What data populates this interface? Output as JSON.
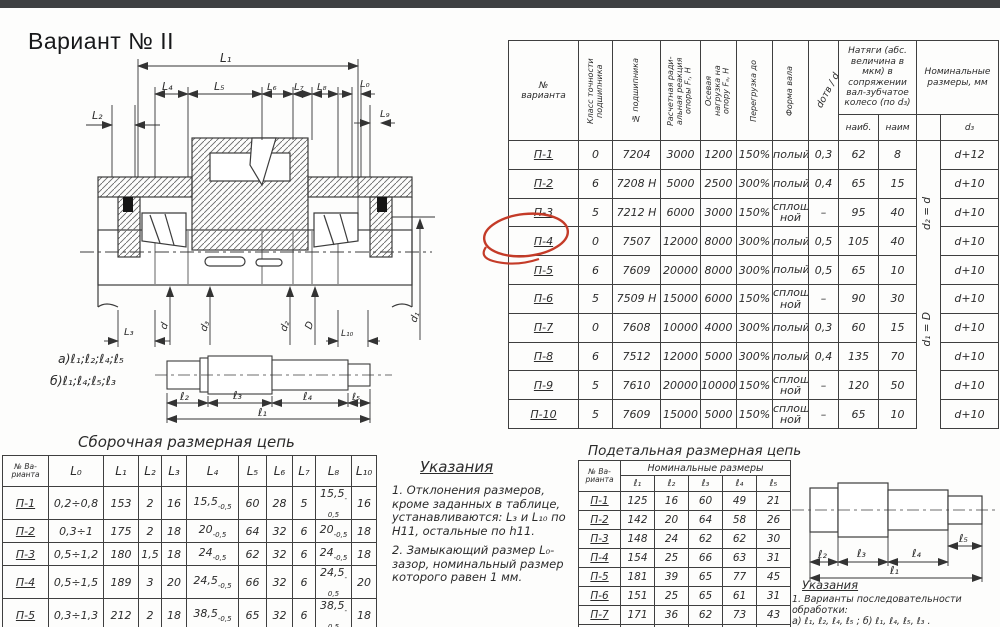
{
  "title": "Вариант № II",
  "colors": {
    "ink": "#2b2b2b",
    "line": "#3f3f3f",
    "red_mark": "#c43b28",
    "topbar": "#3e4042"
  },
  "drawing": {
    "labels": {
      "L1": "L₁",
      "L2": "L₂",
      "L4": "L₄",
      "L5": "L₅",
      "L6": "L₆",
      "L7": "L₇",
      "L8": "L₈",
      "L0": "L₀",
      "L9": "L₉",
      "L3": "L₃",
      "d": "d",
      "d3": "d₃",
      "d2": "d₂",
      "D": "D",
      "L10": "L₁₀",
      "d1": "d₁",
      "seq_a": "а)ℓ₁;ℓ₂;ℓ₄;ℓ₅",
      "seq_b": "б)ℓ₁;ℓ₄;ℓ₅;ℓ₃",
      "s_l1": "ℓ₁",
      "s_l2": "ℓ₂",
      "s_l3": "ℓ₃",
      "s_l4": "ℓ₄",
      "s_l5": "ℓ₅"
    }
  },
  "right_shaft": {
    "labels": {
      "l1": "ℓ₁",
      "l2": "ℓ₂",
      "l3": "ℓ₃",
      "l4": "ℓ₄",
      "l5": "ℓ₅"
    }
  },
  "main_table": {
    "header": {
      "variant": "№\nварианта",
      "cls": "Класс точности подшипника",
      "bearing_no": "№ подшипника",
      "radial": "Расчетная ради-альная реакция опоры Fᵣ, Н",
      "axial": "Осевая нагрузка на опору Fₐ, Н",
      "overload": "Перегрузка до",
      "form": "Форма вала",
      "ratio": "dотв / d",
      "tension": "Натяги (абс. величина в мкм) в сопряжении вал-зубчатое колесо (по d₃)",
      "max": "наиб.",
      "min": "наим",
      "nominal": "Номинальные размеры, мм",
      "d3": "d₃",
      "d2_eq": "d₂ = d",
      "d1_eq": "d₁ = D"
    },
    "rows": [
      {
        "v": "П-1",
        "cls": "0",
        "no": "7204",
        "fr": "3000",
        "fa": "1200",
        "ov": "150%",
        "form": "полый",
        "ratio": "0,3",
        "max": "62",
        "min": "8",
        "d3": "d+12"
      },
      {
        "v": "П-2",
        "cls": "6",
        "no": "7208 Н",
        "fr": "5000",
        "fa": "2500",
        "ov": "300%",
        "form": "полый",
        "ratio": "0,4",
        "max": "65",
        "min": "15",
        "d3": "d+10"
      },
      {
        "v": "П-3",
        "cls": "5",
        "no": "7212 Н",
        "fr": "6000",
        "fa": "3000",
        "ov": "150%",
        "form": "сплош-ной",
        "ratio": "–",
        "max": "95",
        "min": "40",
        "d3": "d+10"
      },
      {
        "v": "П-4",
        "cls": "0",
        "no": "7507",
        "fr": "12000",
        "fa": "8000",
        "ov": "300%",
        "form": "полый",
        "ratio": "0,5",
        "max": "105",
        "min": "40",
        "d3": "d+10"
      },
      {
        "v": "П-5",
        "cls": "6",
        "no": "7609",
        "fr": "20000",
        "fa": "8000",
        "ov": "300%",
        "form": "полый",
        "ratio": "0,5",
        "max": "65",
        "min": "10",
        "d3": "d+10"
      },
      {
        "v": "П-6",
        "cls": "5",
        "no": "7509 Н",
        "fr": "15000",
        "fa": "6000",
        "ov": "150%",
        "form": "сплош-ной",
        "ratio": "–",
        "max": "90",
        "min": "30",
        "d3": "d+10"
      },
      {
        "v": "П-7",
        "cls": "0",
        "no": "7608",
        "fr": "10000",
        "fa": "4000",
        "ov": "300%",
        "form": "полый",
        "ratio": "0,3",
        "max": "60",
        "min": "15",
        "d3": "d+10"
      },
      {
        "v": "П-8",
        "cls": "6",
        "no": "7512",
        "fr": "12000",
        "fa": "5000",
        "ov": "300%",
        "form": "полый",
        "ratio": "0,4",
        "max": "135",
        "min": "70",
        "d3": "d+10"
      },
      {
        "v": "П-9",
        "cls": "5",
        "no": "7610",
        "fr": "20000",
        "fa": "10000",
        "ov": "150%",
        "form": "сплош-ной",
        "ratio": "–",
        "max": "120",
        "min": "50",
        "d3": "d+10"
      },
      {
        "v": "П-10",
        "cls": "5",
        "no": "7609",
        "fr": "15000",
        "fa": "5000",
        "ov": "150%",
        "form": "сплош-ной",
        "ratio": "–",
        "max": "65",
        "min": "10",
        "d3": "d+10"
      }
    ]
  },
  "assembly_table": {
    "title": "Сборочная размерная цепь",
    "col_variant": "№ Ва-\nрианта",
    "cols": {
      "l0": "L₀",
      "l1": "L₁",
      "l2": "L₂",
      "l3": "L₃",
      "l4": "L₄",
      "l5": "L₅",
      "l6": "L₆",
      "l7": "L₇",
      "l8": "L₈",
      "l10": "L₁₀"
    },
    "rows": [
      {
        "v": "П-1",
        "l0": "0,2÷0,8",
        "l1": "153",
        "l2": "2",
        "l3": "16",
        "l4": "15,5",
        "l4t": "-0,5",
        "l5": "60",
        "l6": "28",
        "l7": "5",
        "l8": "15,5",
        "l8t": "-0,5",
        "l10": "16"
      },
      {
        "v": "П-2",
        "l0": "0,3÷1",
        "l1": "175",
        "l2": "2",
        "l3": "18",
        "l4": "20",
        "l4t": "-0,5",
        "l5": "64",
        "l6": "32",
        "l7": "6",
        "l8": "20",
        "l8t": "-0,5",
        "l10": "18"
      },
      {
        "v": "П-3",
        "l0": "0,5÷1,2",
        "l1": "180",
        "l2": "1,5",
        "l3": "18",
        "l4": "24",
        "l4t": "-0,5",
        "l5": "62",
        "l6": "32",
        "l7": "6",
        "l8": "24",
        "l8t": "-0,5",
        "l10": "18"
      },
      {
        "v": "П-4",
        "l0": "0,5÷1,5",
        "l1": "189",
        "l2": "3",
        "l3": "20",
        "l4": "24,5",
        "l4t": "-0,5",
        "l5": "66",
        "l6": "32",
        "l7": "6",
        "l8": "24,5",
        "l8t": "-0,5",
        "l10": "20"
      },
      {
        "v": "П-5",
        "l0": "0,3÷1,3",
        "l1": "212",
        "l2": "2",
        "l3": "18",
        "l4": "38,5",
        "l4t": "-0,5",
        "l5": "65",
        "l6": "32",
        "l7": "6",
        "l8": "38,5",
        "l8t": "-0,5",
        "l10": "18"
      },
      {
        "v": "П-6",
        "l0": "0,5÷1,8",
        "l1": "188",
        "l2": "2",
        "l3": "20",
        "l4": "25",
        "l4t": "-0,5",
        "l5": "65",
        "l6": "30",
        "l7": "6",
        "l8": "25",
        "l8t": "-0,5",
        "l10": "20"
      }
    ]
  },
  "detail_table": {
    "title": "Подетальная размерная цепь",
    "col_variant": "№ Ва-\nрианта",
    "group": "Номинальные размеры",
    "cols": {
      "c1": "ℓ₁",
      "c2": "ℓ₂",
      "c3": "ℓ₃",
      "c4": "ℓ₄",
      "c5": "ℓ₅"
    },
    "rows": [
      {
        "v": "П-1",
        "c1": "125",
        "c2": "16",
        "c3": "60",
        "c4": "49",
        "c5": "21"
      },
      {
        "v": "П-2",
        "c1": "142",
        "c2": "20",
        "c3": "64",
        "c4": "58",
        "c5": "26"
      },
      {
        "v": "П-3",
        "c1": "148",
        "c2": "24",
        "c3": "62",
        "c4": "62",
        "c5": "30"
      },
      {
        "v": "П-4",
        "c1": "154",
        "c2": "25",
        "c3": "66",
        "c4": "63",
        "c5": "31"
      },
      {
        "v": "П-5",
        "c1": "181",
        "c2": "39",
        "c3": "65",
        "c4": "77",
        "c5": "45"
      },
      {
        "v": "П-6",
        "c1": "151",
        "c2": "25",
        "c3": "65",
        "c4": "61",
        "c5": "31"
      },
      {
        "v": "П-7",
        "c1": "171",
        "c2": "36",
        "c3": "62",
        "c4": "73",
        "c5": "43"
      },
      {
        "v": "П-8",
        "c1": "185",
        "c2": "38",
        "c3": "48",
        "c4": "55",
        "c5": "35"
      }
    ]
  },
  "instructions_mid": {
    "title": "Указания",
    "item1": "1. Отклонения размеров, кроме заданных в таблице, устанавливаются: L₃ и L₁₀ по H11, остальные по h11.",
    "item2": "2. Замыкающий размер L₀-зазор, номинальный размер которого равен 1 мм."
  },
  "instructions_right": {
    "title": "Указания",
    "item1": "1. Варианты последовательности обработки:",
    "item1ab": "а) ℓ₁, ℓ₂, ℓ₄, ℓ₅ ;      б) ℓ₁, ℓ₄, ℓ₅, ℓ₃ .",
    "item2": "2. Назначить допуски и отклонения обра-"
  }
}
